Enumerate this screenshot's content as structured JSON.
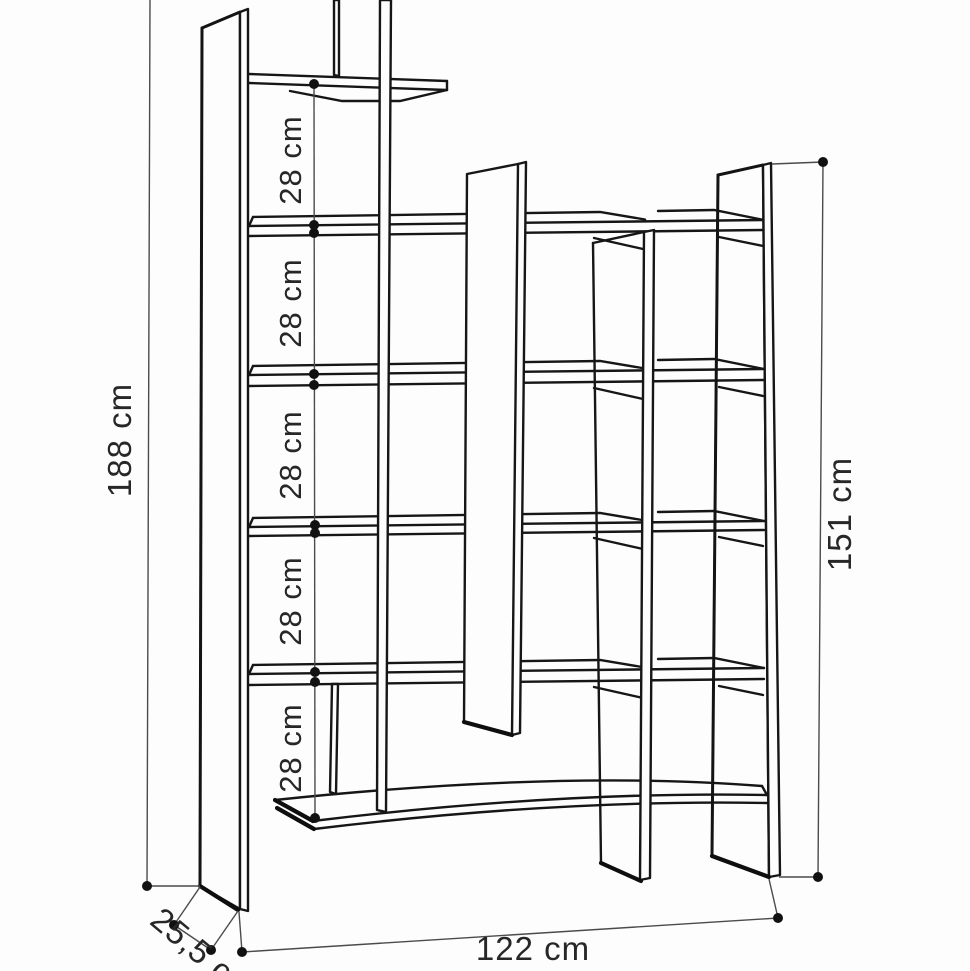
{
  "diagram": {
    "title": "bookshelf-dimension-drawing",
    "unit": "cm",
    "dims": {
      "total_height": {
        "label": "188 cm",
        "value": 188
      },
      "inner_height": {
        "label": "151 cm",
        "value": 151
      },
      "width": {
        "label": "122 cm",
        "value": 122
      },
      "depth": {
        "label": "25,5 cm",
        "value": 25.5
      },
      "gaps": [
        {
          "label": "28 cm",
          "value": 28
        },
        {
          "label": "28 cm",
          "value": 28
        },
        {
          "label": "28 cm",
          "value": 28
        },
        {
          "label": "28 cm",
          "value": 28
        },
        {
          "label": "28 cm",
          "value": 28
        }
      ]
    },
    "parts": {
      "left_panel": "left side panel",
      "right_panel": "right side panel",
      "shelves": 6,
      "vertical_dividers": 4
    }
  }
}
